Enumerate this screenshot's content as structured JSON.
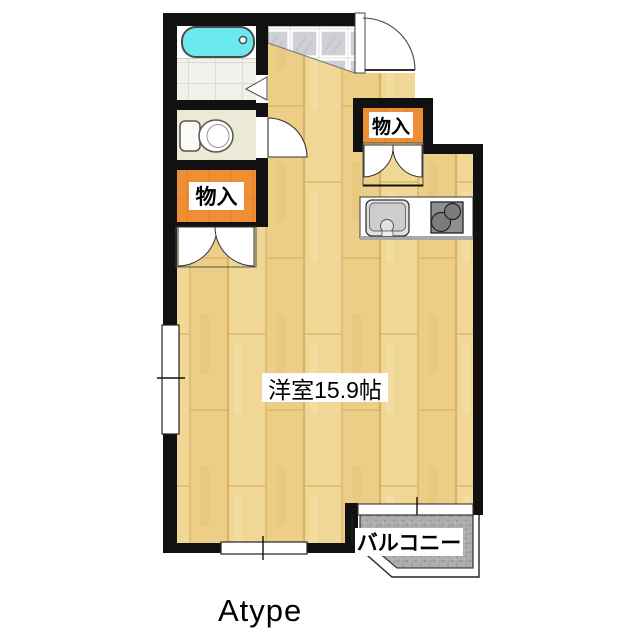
{
  "plan": {
    "type_label": "Atype",
    "rooms": {
      "main_room": "洋室15.9帖",
      "storage_left": "物入",
      "storage_right": "物入",
      "balcony": "バルコニー"
    }
  },
  "colors": {
    "wall": "#111111",
    "floor": "#F1D795",
    "floor_alt": "#ECCE87",
    "storage": "#EF8F35",
    "bathtub": "#6BE9EC",
    "toilet_floor": "#ECEAD6",
    "entry_tile": "#CFCFD4",
    "bath_tile": "#F0F0EC",
    "balcony": "#AEAEAE",
    "stove": "#8F8F8F",
    "counter": "#FFFFFF"
  },
  "icons": {
    "bathtub": "bathtub-icon",
    "toilet": "toilet-icon",
    "kitchen_sink": "kitchen-sink-icon",
    "stove": "stove-icon",
    "door_swing": "door-swing-icon",
    "double_door": "double-door-icon",
    "window": "window-icon"
  }
}
